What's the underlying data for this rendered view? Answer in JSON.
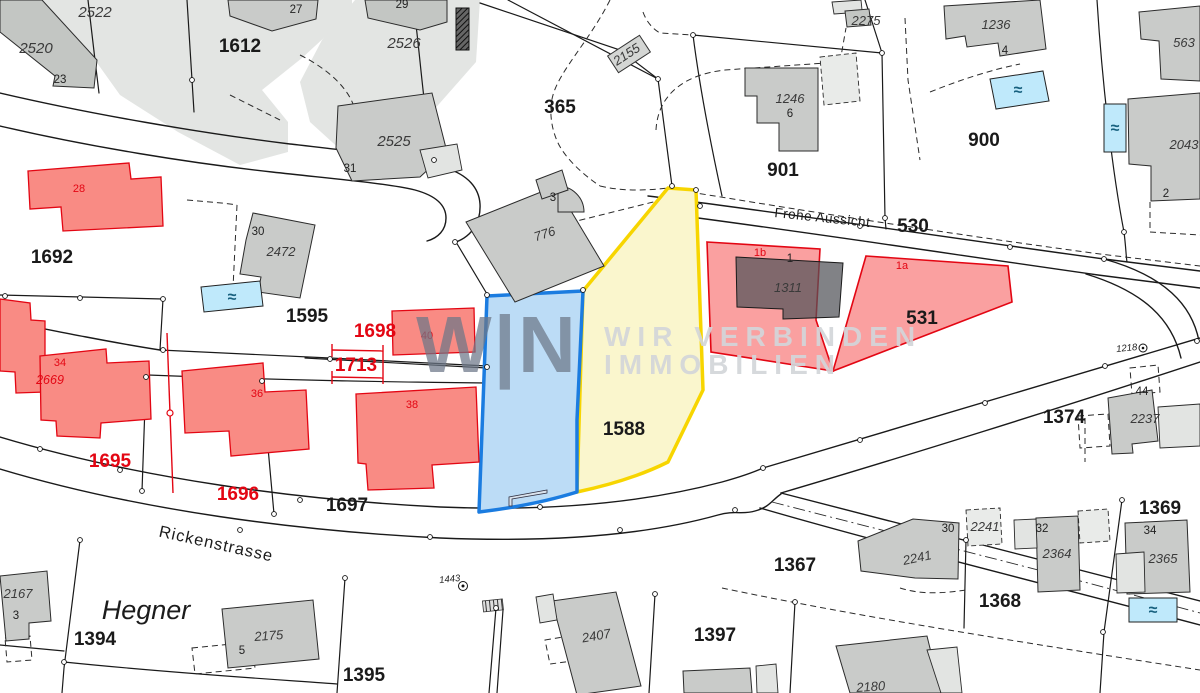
{
  "map": {
    "type": "cadastral-plan",
    "watermark": {
      "logo": "W|N",
      "line1": "WIR VERBINDEN",
      "line2": "IMMOBILIEN"
    },
    "icons": {
      "pool_wave": "≈"
    },
    "highlight_colors": {
      "blue_border": "#1b7ce0",
      "blue_fill": "#bcdcf6",
      "yellow_border": "#f7d500",
      "yellow_fill": "#faf6cd",
      "red_border": "#e30613",
      "red_fill": "rgba(246,82,82,0.55)",
      "pool_fill": "#bfe9fb"
    },
    "labels": [
      {
        "t": "2522",
        "x": 95,
        "y": 17,
        "c": "bldg-lg"
      },
      {
        "t": "2520",
        "x": 36,
        "y": 53,
        "c": "bldg-lg"
      },
      {
        "t": "23",
        "x": 60,
        "y": 83,
        "c": "house"
      },
      {
        "t": "1612",
        "x": 240,
        "y": 52,
        "c": "parcel"
      },
      {
        "t": "27",
        "x": 296,
        "y": 13,
        "c": "house"
      },
      {
        "t": "29",
        "x": 402,
        "y": 8,
        "c": "house"
      },
      {
        "t": "2526",
        "x": 404,
        "y": 48,
        "c": "bldg-lg"
      },
      {
        "t": "2525",
        "x": 394,
        "y": 146,
        "c": "bldg-lg"
      },
      {
        "t": "31",
        "x": 350,
        "y": 172,
        "c": "house"
      },
      {
        "t": "2155",
        "x": 629,
        "y": 58,
        "c": "bldg",
        "r": -33
      },
      {
        "t": "365",
        "x": 560,
        "y": 113,
        "c": "parcel"
      },
      {
        "t": "2275",
        "x": 866,
        "y": 25,
        "c": "bldg"
      },
      {
        "t": "1246",
        "x": 790,
        "y": 103,
        "c": "bldg"
      },
      {
        "t": "6",
        "x": 790,
        "y": 117,
        "c": "house"
      },
      {
        "t": "901",
        "x": 783,
        "y": 176,
        "c": "parcel"
      },
      {
        "t": "1236",
        "x": 996,
        "y": 29,
        "c": "bldg"
      },
      {
        "t": "4",
        "x": 1005,
        "y": 54,
        "c": "house"
      },
      {
        "t": "900",
        "x": 984,
        "y": 146,
        "c": "parcel"
      },
      {
        "t": "563",
        "x": 1184,
        "y": 47,
        "c": "bldg"
      },
      {
        "t": "2043",
        "x": 1184,
        "y": 149,
        "c": "bldg"
      },
      {
        "t": "2",
        "x": 1166,
        "y": 197,
        "c": "house"
      },
      {
        "t": "Frohe Aussicht",
        "x": 822,
        "y": 222,
        "c": "street2",
        "r": 6
      },
      {
        "t": "530",
        "x": 913,
        "y": 232,
        "c": "parcel"
      },
      {
        "t": "1b",
        "x": 760,
        "y": 256,
        "c": "house-red"
      },
      {
        "t": "1",
        "x": 790,
        "y": 262,
        "c": "house"
      },
      {
        "t": "1a",
        "x": 902,
        "y": 269,
        "c": "house-red"
      },
      {
        "t": "1311",
        "x": 788,
        "y": 292,
        "c": "bldg"
      },
      {
        "t": "531",
        "x": 922,
        "y": 324,
        "c": "parcel"
      },
      {
        "t": "1692",
        "x": 52,
        "y": 263,
        "c": "parcel"
      },
      {
        "t": "30",
        "x": 258,
        "y": 235,
        "c": "house"
      },
      {
        "t": "2472",
        "x": 281,
        "y": 256,
        "c": "bldg"
      },
      {
        "t": "1595",
        "x": 307,
        "y": 322,
        "c": "parcel"
      },
      {
        "t": "1698",
        "x": 375,
        "y": 337,
        "c": "parcel-red"
      },
      {
        "t": "1713",
        "x": 356,
        "y": 371,
        "c": "parcel-red"
      },
      {
        "t": "40",
        "x": 427,
        "y": 339,
        "c": "house-red"
      },
      {
        "t": "28",
        "x": 79,
        "y": 192,
        "c": "house-red"
      },
      {
        "t": "34",
        "x": 60,
        "y": 366,
        "c": "house-red"
      },
      {
        "t": "2669",
        "x": 50,
        "y": 384,
        "c": "bldg-red"
      },
      {
        "t": "36",
        "x": 257,
        "y": 397,
        "c": "house-red"
      },
      {
        "t": "38",
        "x": 412,
        "y": 408,
        "c": "house-red"
      },
      {
        "t": "776",
        "x": 546,
        "y": 238,
        "c": "bldg",
        "r": -18
      },
      {
        "t": "3",
        "x": 553,
        "y": 201,
        "c": "house"
      },
      {
        "t": "1695",
        "x": 110,
        "y": 467,
        "c": "parcel-red"
      },
      {
        "t": "1696",
        "x": 238,
        "y": 500,
        "c": "parcel-red"
      },
      {
        "t": "1697",
        "x": 347,
        "y": 511,
        "c": "parcel"
      },
      {
        "t": "1588",
        "x": 624,
        "y": 435,
        "c": "parcel"
      },
      {
        "t": "Rickenstrasse",
        "x": 215,
        "y": 549,
        "c": "street",
        "r": 12.5
      },
      {
        "t": "1443",
        "x": 450,
        "y": 582,
        "c": "tiny",
        "r": -6
      },
      {
        "t": "1374",
        "x": 1064,
        "y": 423,
        "c": "parcel"
      },
      {
        "t": "1218",
        "x": 1127,
        "y": 351,
        "c": "tiny",
        "r": -6
      },
      {
        "t": "44",
        "x": 1142,
        "y": 395,
        "c": "house"
      },
      {
        "t": "2237",
        "x": 1145,
        "y": 423,
        "c": "bldg"
      },
      {
        "t": "1367",
        "x": 795,
        "y": 571,
        "c": "parcel"
      },
      {
        "t": "30",
        "x": 948,
        "y": 532,
        "c": "house"
      },
      {
        "t": "2241",
        "x": 918,
        "y": 562,
        "c": "bldg",
        "r": -12
      },
      {
        "t": "2241",
        "x": 985,
        "y": 531,
        "c": "bldg"
      },
      {
        "t": "32",
        "x": 1042,
        "y": 532,
        "c": "house"
      },
      {
        "t": "2364",
        "x": 1057,
        "y": 558,
        "c": "bldg"
      },
      {
        "t": "1369",
        "x": 1160,
        "y": 514,
        "c": "parcel"
      },
      {
        "t": "34",
        "x": 1150,
        "y": 534,
        "c": "house"
      },
      {
        "t": "2365",
        "x": 1163,
        "y": 563,
        "c": "bldg"
      },
      {
        "t": "1368",
        "x": 1000,
        "y": 607,
        "c": "parcel"
      },
      {
        "t": "2167",
        "x": 18,
        "y": 598,
        "c": "bldg"
      },
      {
        "t": "3",
        "x": 16,
        "y": 619,
        "c": "house"
      },
      {
        "t": "Hegner",
        "x": 146,
        "y": 619,
        "c": "place"
      },
      {
        "t": "1394",
        "x": 95,
        "y": 645,
        "c": "parcel"
      },
      {
        "t": "2175",
        "x": 269,
        "y": 640,
        "c": "bldg",
        "r": -4
      },
      {
        "t": "5",
        "x": 242,
        "y": 654,
        "c": "house"
      },
      {
        "t": "1395",
        "x": 364,
        "y": 681,
        "c": "parcel"
      },
      {
        "t": "2407",
        "x": 597,
        "y": 640,
        "c": "bldg",
        "r": -10
      },
      {
        "t": "1397",
        "x": 715,
        "y": 641,
        "c": "parcel"
      },
      {
        "t": "2180",
        "x": 871,
        "y": 691,
        "c": "bldg",
        "r": -4
      }
    ]
  }
}
